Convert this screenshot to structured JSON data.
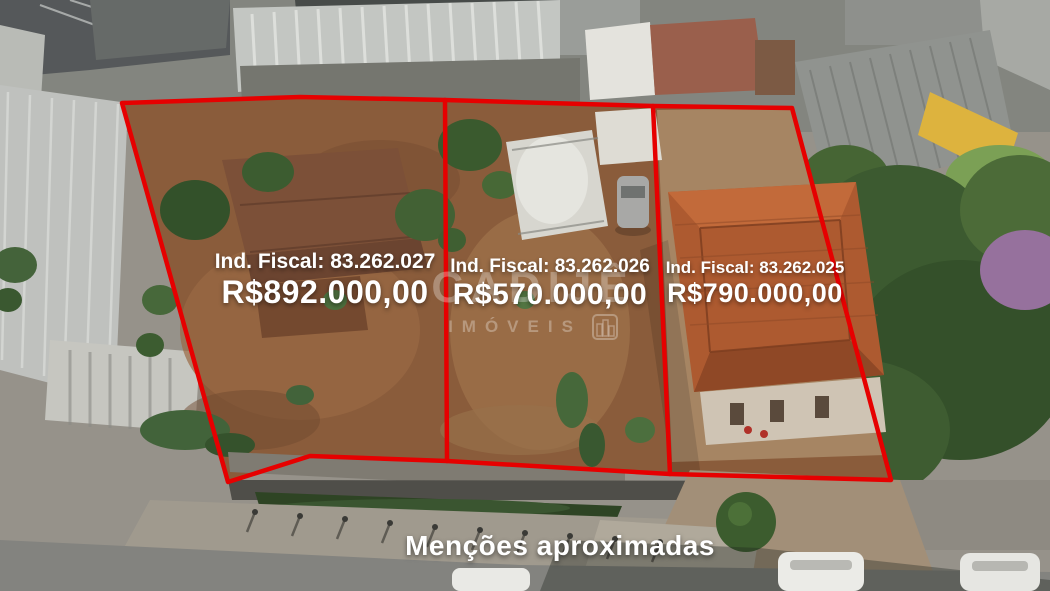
{
  "caption": {
    "text": "Menções aproximadas"
  },
  "watermark": {
    "brand": "CADIJÊ",
    "subtitle": "IMÓVEIS",
    "icon": "buildings-icon"
  },
  "lots": [
    {
      "id_label": "Ind. Fiscal: 83.262.027",
      "price": "R$892.000,00"
    },
    {
      "id_label": "Ind. Fiscal: 83.262.026",
      "price": "R$570.000,00"
    },
    {
      "id_label": "Ind. Fiscal: 83.262.025",
      "price": "R$790.000,00"
    }
  ],
  "colors": {
    "boundary_red": "#e60000",
    "label_white": "#ffffff"
  }
}
